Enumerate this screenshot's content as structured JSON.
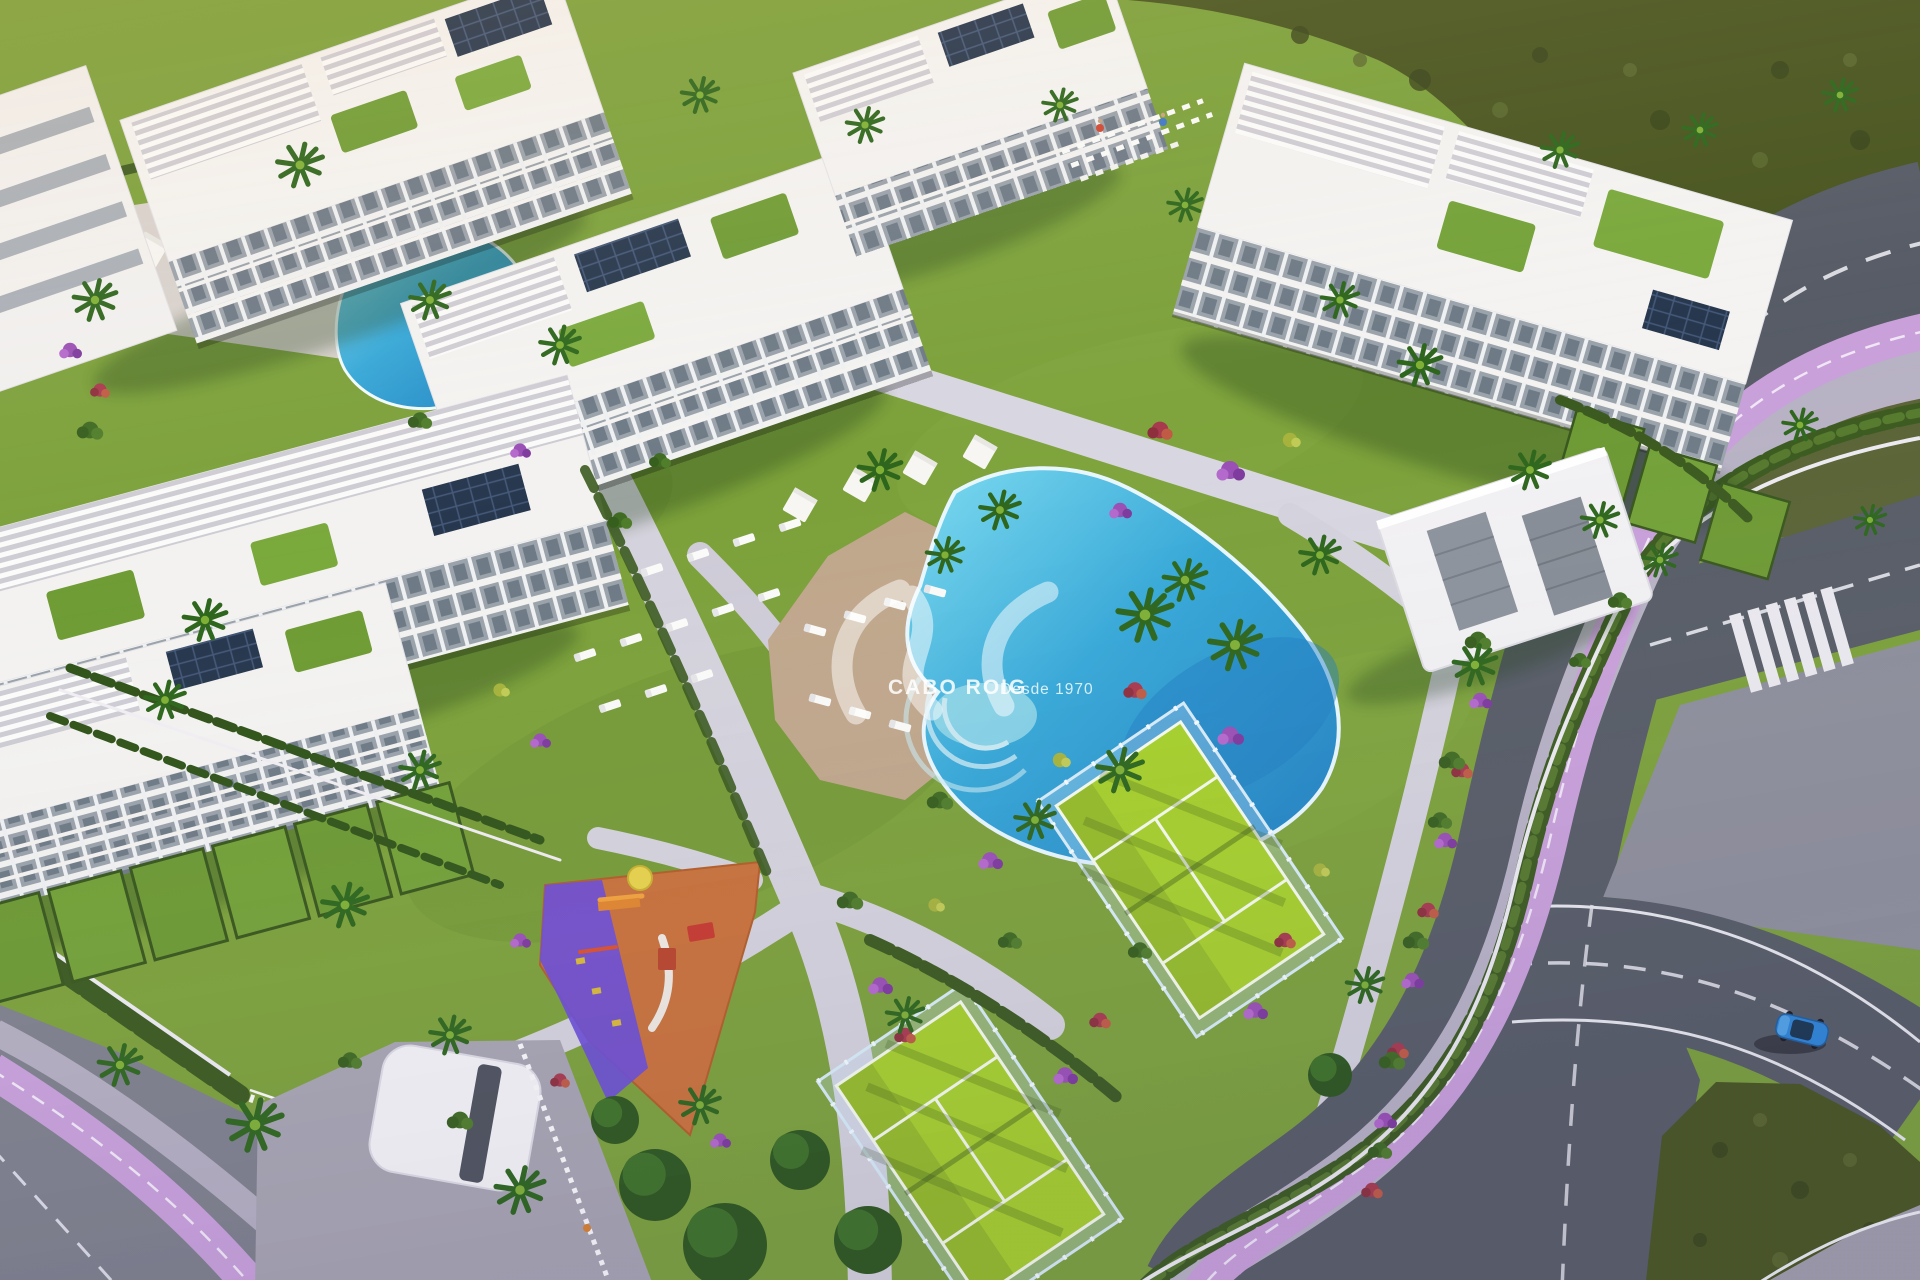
{
  "watermark": {
    "logo": "sis-wave-monogram",
    "brand": "CABO ROIG",
    "tagline": "Desde 1970"
  },
  "scene": {
    "type": "aerial-3d-architectural-render",
    "subject": "white apartment resort complex with communal pools, padel courts, playground and perimeter roads",
    "elements": [
      "apartment blocks with roof terraces, pergolas and solar panels",
      "lagoon-style communal pool with sun loungers and daybeds",
      "secondary communal pool with shade umbrellas",
      "clubhouse with solar roof panels",
      "two padel courts with glass fencing",
      "children's playground with orange and purple safety surface",
      "landscaped gardens, palm trees and flower beds",
      "perimeter road with cycle lane, sidewalk, hedge and zebra crosswalk",
      "entrance gate canopy and paved plaza",
      "blue car on curved road",
      "undeveloped scrubland hills"
    ]
  },
  "palette": {
    "grass": "#7ca13a",
    "scrub": "#49551f",
    "road": "#575c66",
    "pavement": "#8e8f9b",
    "sidewalk": "#b8b2c5",
    "cycle_lane": "#c9a0da",
    "pool_water": "#2f9fd0",
    "pool_deck": "#c0a78c",
    "building_white": "#f4f3f1",
    "facade_glass": "#9aa2ab",
    "solar_panel": "#27374d",
    "padel_court": "#a6d02b",
    "playground_orange": "#c9713a",
    "playground_purple": "#6b4ed6",
    "hedge_green": "#3b5a1f",
    "flower_purple": "#9a4fb5",
    "flower_red": "#a83a4e",
    "car_blue": "#2f86d8",
    "watermark_white": "#ffffff"
  }
}
